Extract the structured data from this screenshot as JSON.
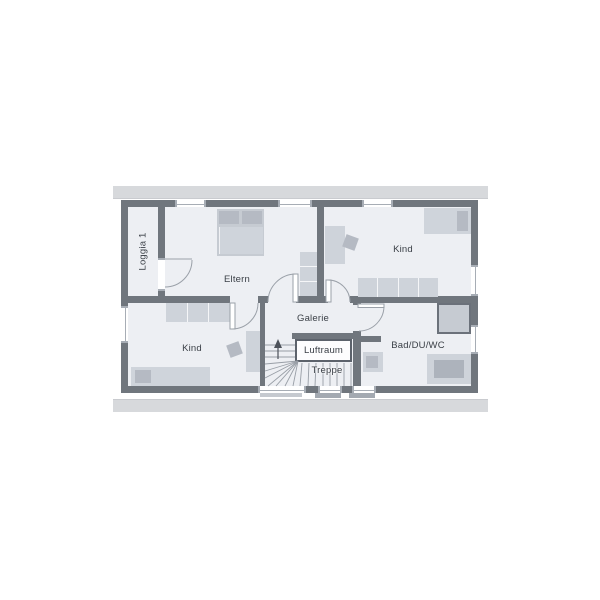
{
  "plan": {
    "rooms": {
      "loggia": {
        "label": "Loggia 1"
      },
      "eltern": {
        "label": "Eltern"
      },
      "kind_top": {
        "label": "Kind"
      },
      "kind_bottom": {
        "label": "Kind"
      },
      "galerie": {
        "label": "Galerie"
      },
      "luftraum": {
        "label": "Luftraum"
      },
      "treppe": {
        "label": "Treppe"
      },
      "bad": {
        "label": "Bad/DU/WC"
      }
    },
    "colors": {
      "wall": "#70767d",
      "floor": "#edeff3",
      "furniture_light": "#ced3da",
      "furniture_dark": "#b5bac3",
      "roof_band": "#d7d9dc",
      "line": "#9aa0a8",
      "label_text": "#3b4047",
      "luftraum_border": "#5c626b"
    },
    "icons": [
      "stairs-up-arrow-icon",
      "door-swing-arc",
      "window"
    ]
  }
}
